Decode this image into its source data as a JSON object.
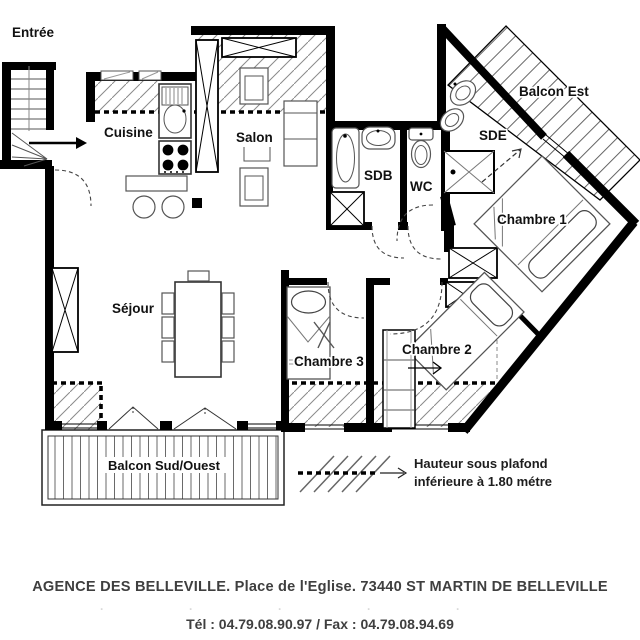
{
  "plan": {
    "rooms": {
      "entree": "Entrée",
      "cuisine": "Cuisine",
      "salon": "Salon",
      "sejour": "Séjour",
      "sdb": "SDB",
      "wc": "WC",
      "sde": "SDE",
      "chambre1": "Chambre 1",
      "chambre2": "Chambre 2",
      "chambre3": "Chambre 3",
      "balcon_est": "Balcon Est",
      "balcon_sud_ouest": "Balcon Sud/Ouest"
    },
    "legend": {
      "line1": "Hauteur sous plafond",
      "line2": "inférieure à 1.80 métre"
    }
  },
  "footer": {
    "agency": "AGENCE DES BELLEVILLE. Place de l'Eglise. 73440 ST MARTIN DE BELLEVILLE",
    "phone": "Tél : 04.79.08.90.97 / Fax : 04.79.08.94.69",
    "ghost": "·····"
  },
  "colors": {
    "wall": "#000000",
    "fixture": "#555555",
    "hatch": "#8a8a8a",
    "label": "#111111",
    "footer_text": "#3f3f3f"
  }
}
